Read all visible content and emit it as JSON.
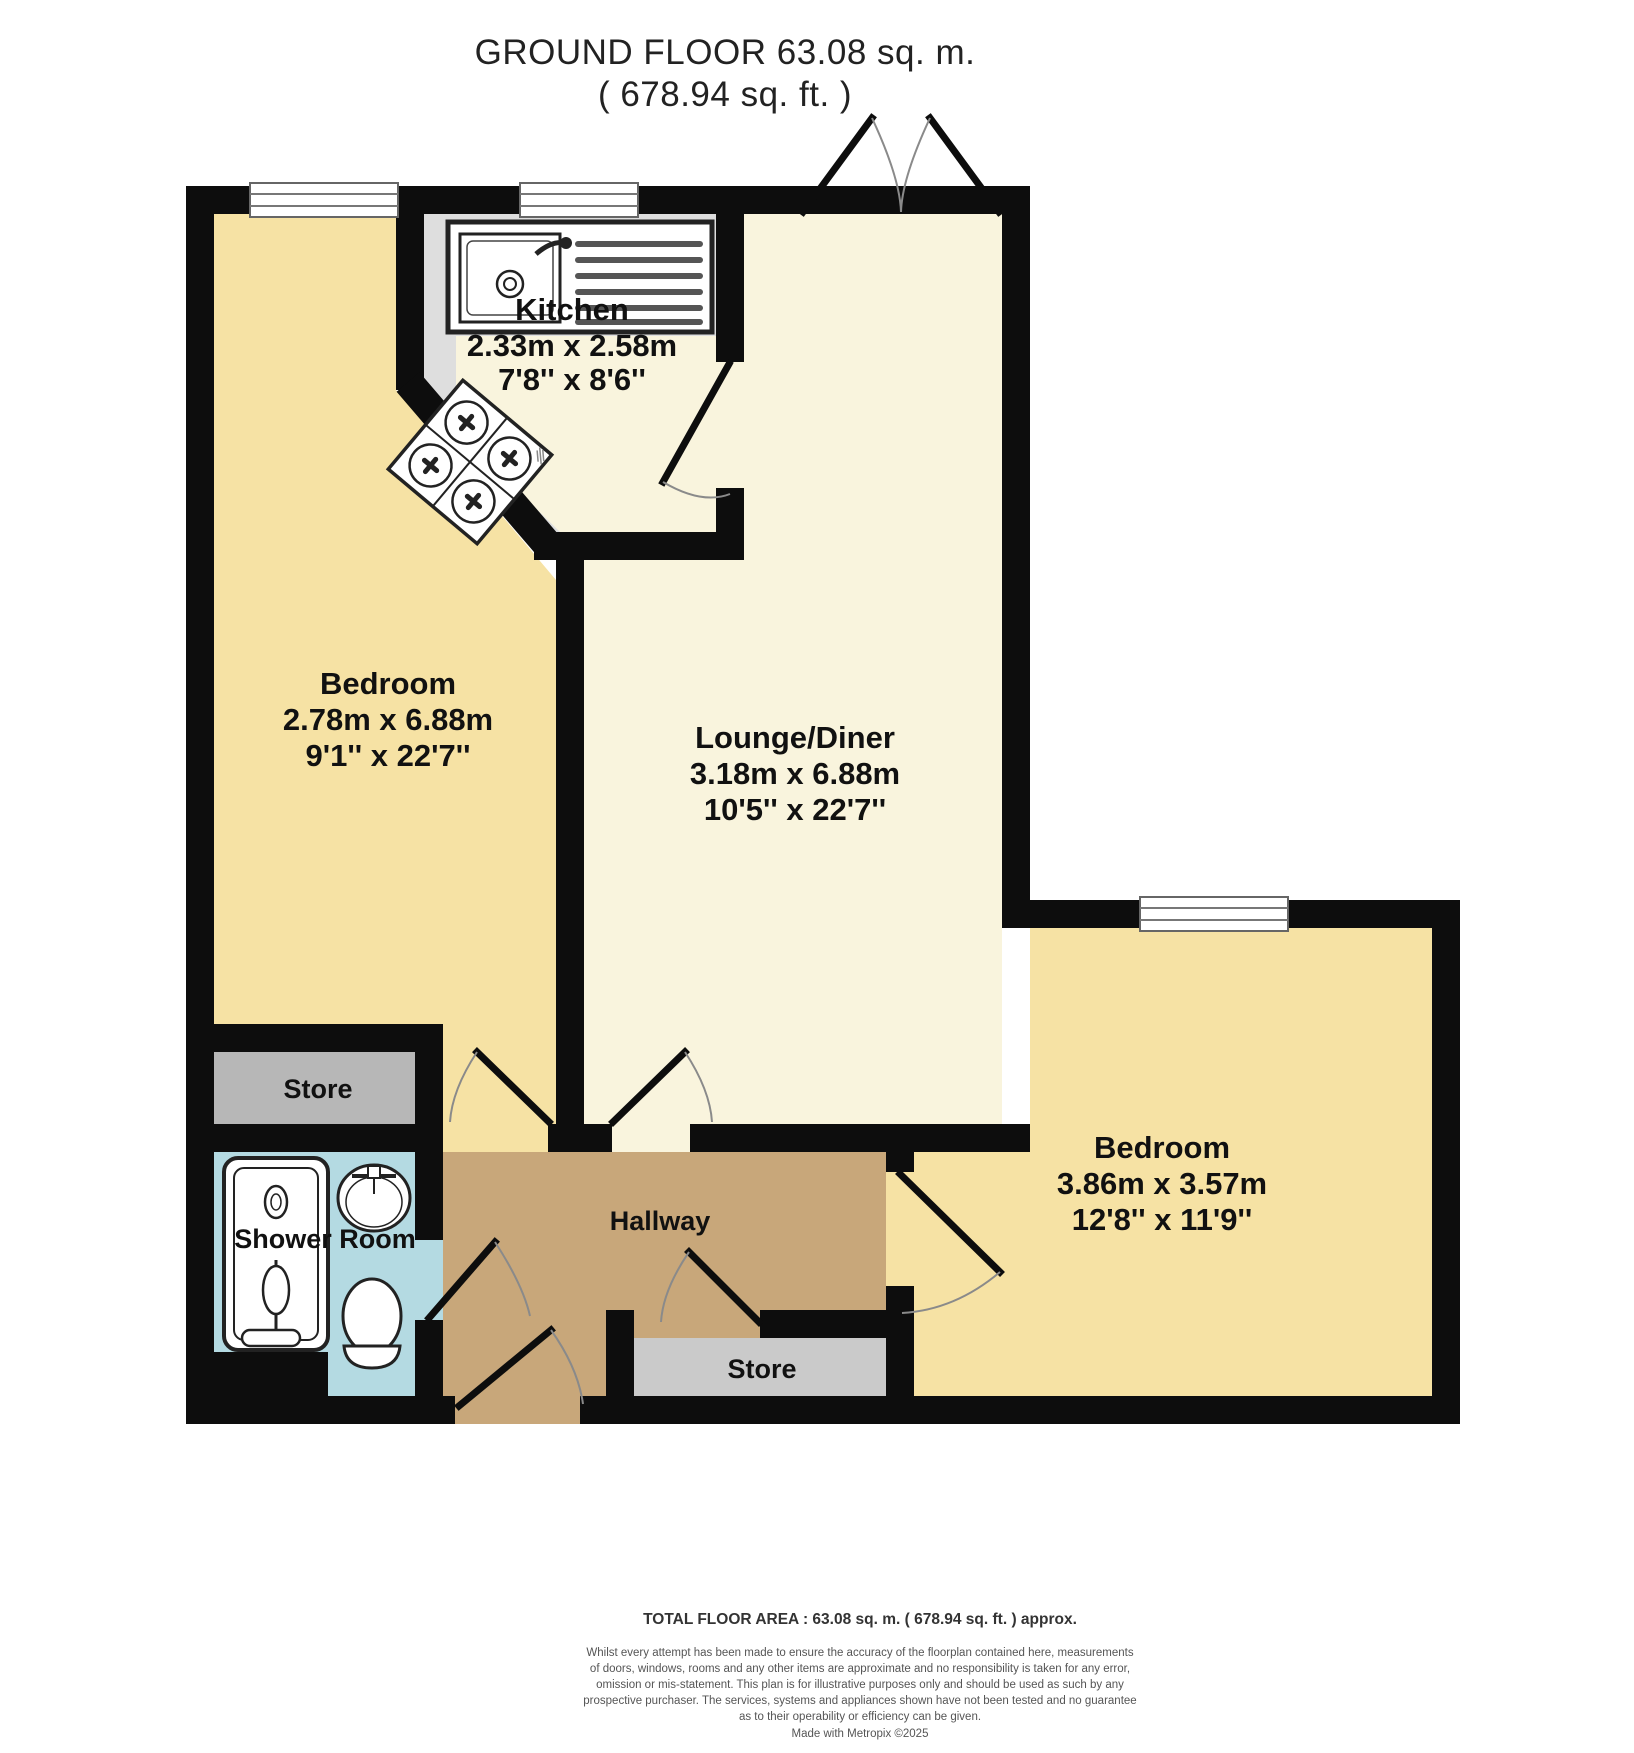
{
  "title": {
    "line1": "GROUND FLOOR 63.08 sq. m.",
    "line2": "( 678.94 sq. ft. )"
  },
  "rooms": {
    "kitchen": {
      "name": "Kitchen",
      "metric": "2.33m x 2.58m",
      "imperial": "7'8'' x 8'6''"
    },
    "bedroom_left": {
      "name": "Bedroom",
      "metric": "2.78m x 6.88m",
      "imperial": "9'1'' x 22'7''"
    },
    "lounge": {
      "name": "Lounge/Diner",
      "metric": "3.18m x 6.88m",
      "imperial": "10'5'' x 22'7''"
    },
    "bedroom_right": {
      "name": "Bedroom",
      "metric": "3.86m x 3.57m",
      "imperial": "12'8'' x 11'9''"
    },
    "shower_room": {
      "name": "Shower Room"
    },
    "hallway": {
      "name": "Hallway"
    },
    "store_upper": {
      "name": "Store"
    },
    "store_lower": {
      "name": "Store"
    }
  },
  "fixtures": {
    "kitchen": [
      "sink-drainer-icon",
      "hob-icon"
    ],
    "shower_room": [
      "shower-cubicle-icon",
      "basin-icon",
      "toilet-icon"
    ]
  },
  "colors": {
    "wall": "#0d0d0d",
    "bedroom_fill": "#f6e2a4",
    "lounge_fill": "#f9f4dd",
    "kitchen_fill": "#dedede",
    "hallway_fill": "#c8a77a",
    "shower_fill": "#b4dae2",
    "store_upper_fill": "#b7b7b7",
    "store_lower_fill": "#cacaca"
  },
  "footer": {
    "total_area": "TOTAL FLOOR AREA : 63.08 sq. m. ( 678.94 sq. ft. ) approx.",
    "disclaimer_lines": [
      "Whilst every attempt has been made to ensure the accuracy of the floorplan contained here, measurements",
      "of doors, windows, rooms and any other items are approximate and no responsibility is taken for any error,",
      "omission or mis-statement. This plan is for illustrative purposes only and should be used as such by any",
      "prospective purchaser. The services, systems and appliances shown have not been tested and no guarantee",
      "as to their operability or efficiency can be given."
    ],
    "credit": "Made with Metropix ©2025"
  }
}
